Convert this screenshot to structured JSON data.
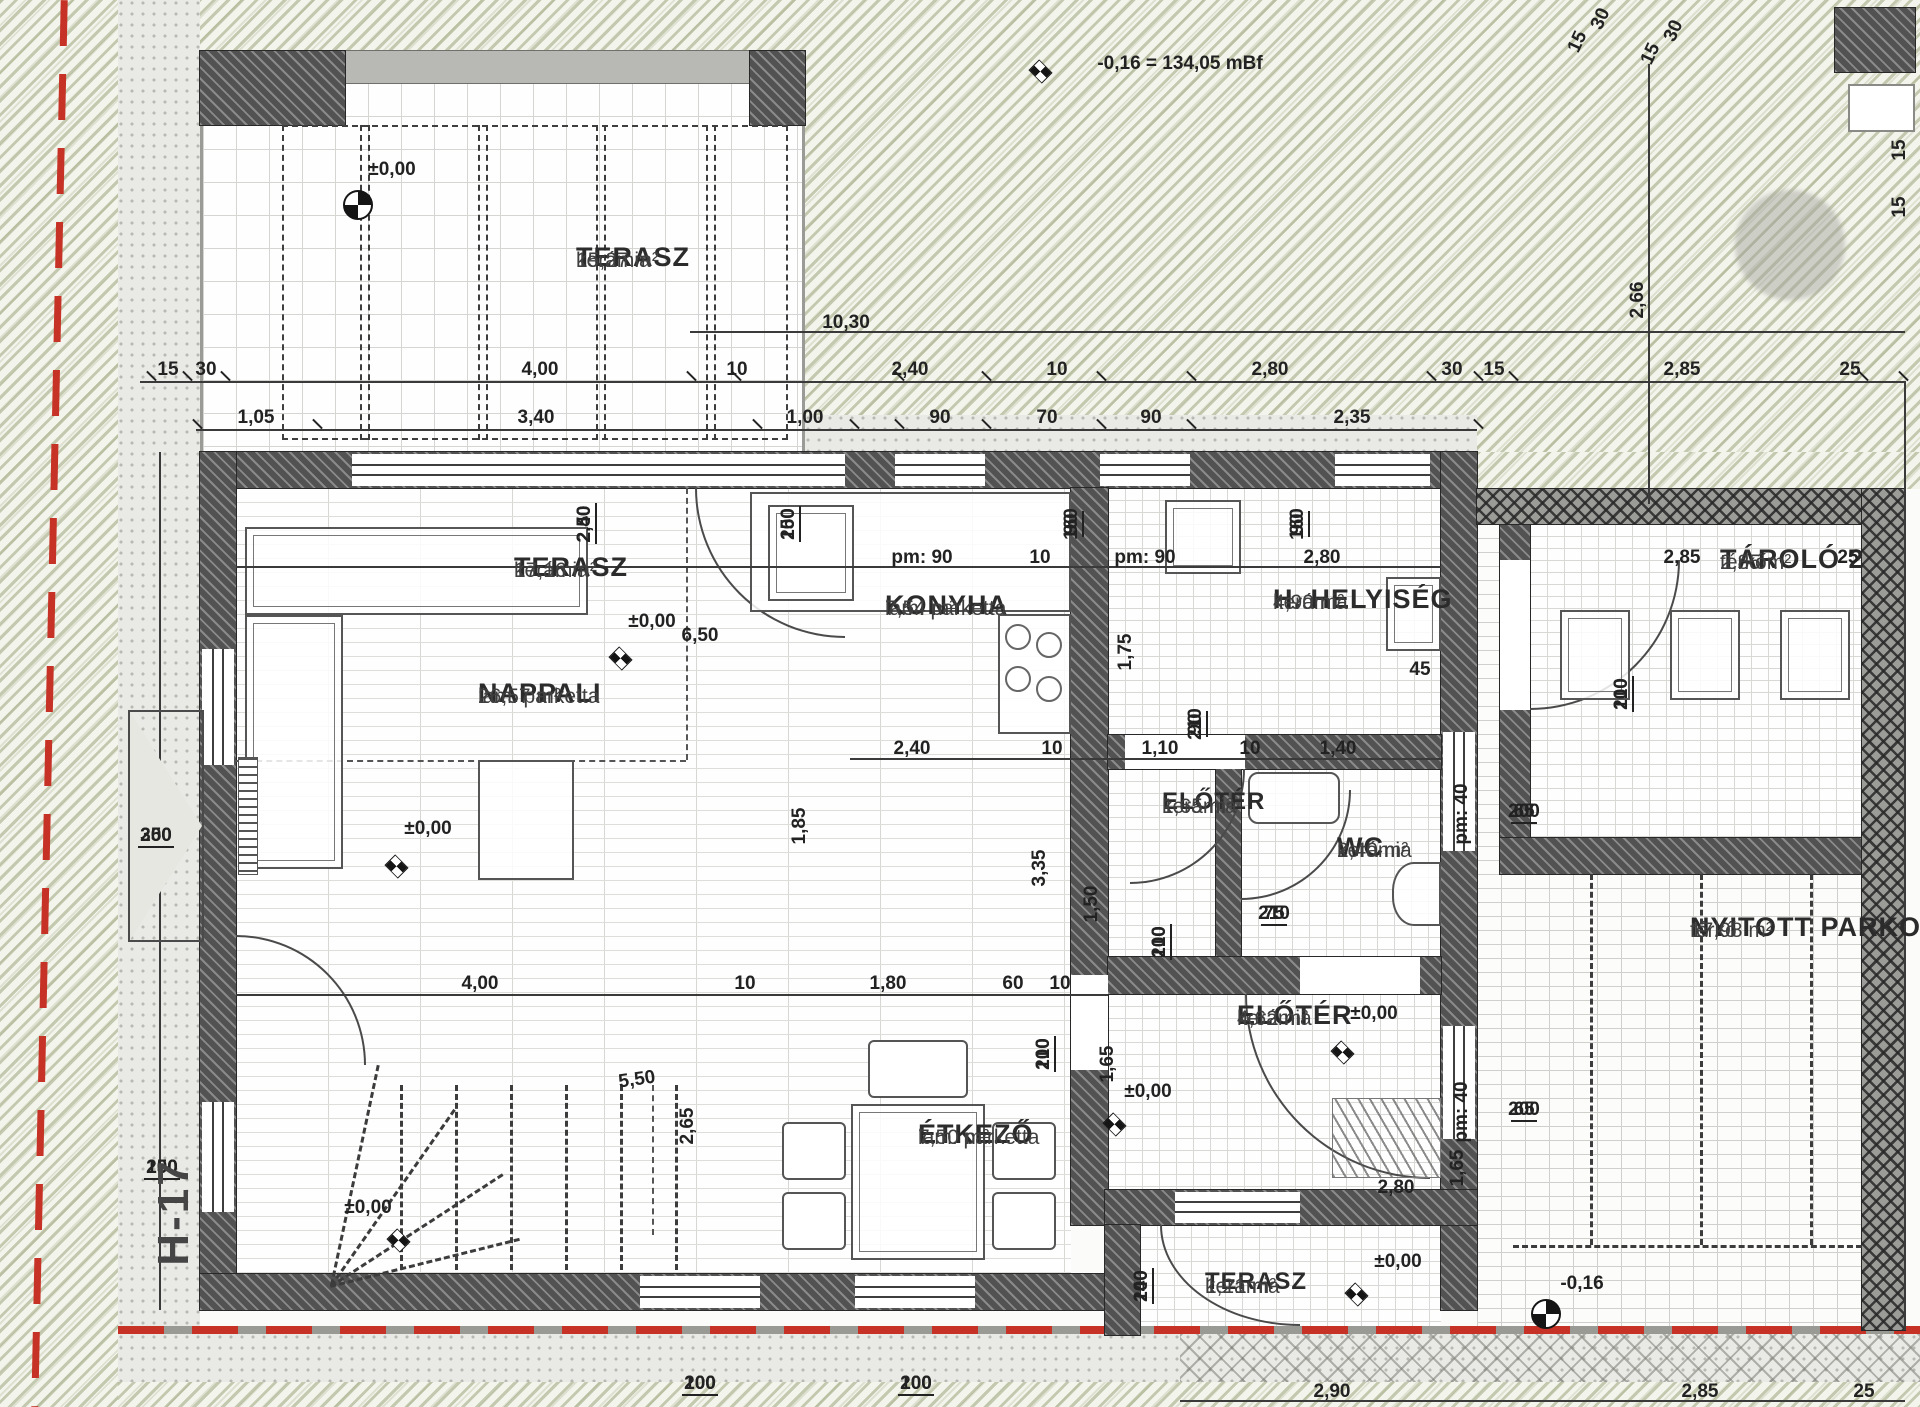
{
  "document": {
    "type": "floor-plan",
    "language": "hu",
    "drawing": "földszinti alaprajz"
  },
  "reference_levels": {
    "benchmark": "-0,16 = 134,05 mBf",
    "zero_level": "±0,00",
    "terrain_level": "-0,16"
  },
  "colors": {
    "wall": "#525252",
    "line": "#3a3a3a",
    "text": "#222222",
    "green_hatch": "#949e72",
    "property_line_red": "#c63226",
    "paper": "#fbfbf9"
  },
  "section_marker": "H-17",
  "rooms": [
    {
      "key": "terasz-felso",
      "name": "TERASZ",
      "material": "kerámia",
      "area": "15,27 m²"
    },
    {
      "key": "terasz-fedett",
      "name": "TERASZ",
      "material": "kerámia",
      "area": "17,16 m²"
    },
    {
      "key": "nappali",
      "name": "NAPPALI",
      "material": "lam. parketta",
      "area": "26,57 m²"
    },
    {
      "key": "konyha",
      "name": "KONYHA",
      "material": "lam. parketta",
      "area": "7,54 m²"
    },
    {
      "key": "h-helyiseg",
      "name": "H. HELYISÉG",
      "material": "kerámia",
      "area": "4,90 m²"
    },
    {
      "key": "eloter-felso",
      "name": "ELŐTÉR",
      "material": "kerámia",
      "area": "1,65 m²"
    },
    {
      "key": "wc",
      "name": "WC",
      "material": "kerámia",
      "area": "2,40 m²"
    },
    {
      "key": "eloter-also",
      "name": "ELŐTÉR",
      "material": "kerámia",
      "area": "4,62 m²"
    },
    {
      "key": "etkezo",
      "name": "ÉTKEZŐ",
      "material": "lam. parketta",
      "area": "7,50 m²"
    },
    {
      "key": "terasz-also",
      "name": "TERASZ",
      "material": "kerámia",
      "area": "1,21 m²"
    },
    {
      "key": "tarolo-2",
      "name": "TÁROLÓ 2",
      "material": "térkő",
      "area": "2,85 m²"
    },
    {
      "key": "nyitott-parkolo",
      "name": "NYITOTT PARKOLÓ",
      "material": "térkő",
      "area": "17,98 m²"
    }
  ],
  "annotations": [
    {
      "t": "-0,16 = 134,05 mBf",
      "x": 1180,
      "y": 64
    },
    {
      "t": "10,30",
      "x": 846,
      "y": 323
    },
    {
      "t": "15",
      "x": 168,
      "y": 370
    },
    {
      "t": "30",
      "x": 206,
      "y": 370
    },
    {
      "t": "4,00",
      "x": 540,
      "y": 370
    },
    {
      "t": "10",
      "x": 737,
      "y": 370
    },
    {
      "t": "2,40",
      "x": 910,
      "y": 370
    },
    {
      "t": "10",
      "x": 1057,
      "y": 370
    },
    {
      "t": "2,80",
      "x": 1270,
      "y": 370
    },
    {
      "t": "30",
      "x": 1452,
      "y": 370
    },
    {
      "t": "15",
      "x": 1494,
      "y": 370
    },
    {
      "t": "2,85",
      "x": 1682,
      "y": 370
    },
    {
      "t": "25",
      "x": 1850,
      "y": 370
    },
    {
      "t": "1,05",
      "x": 256,
      "y": 418
    },
    {
      "t": "3,40",
      "x": 536,
      "y": 418
    },
    {
      "t": "1,00",
      "x": 805,
      "y": 418
    },
    {
      "t": "90",
      "x": 940,
      "y": 418
    },
    {
      "t": "70",
      "x": 1047,
      "y": 418
    },
    {
      "t": "90",
      "x": 1151,
      "y": 418
    },
    {
      "t": "2,35",
      "x": 1352,
      "y": 418
    },
    {
      "t": "2,66",
      "x": 1638,
      "y": 300,
      "r": -90
    },
    {
      "t": "15",
      "x": 1578,
      "y": 42,
      "r": -65
    },
    {
      "t": "30",
      "x": 1601,
      "y": 19,
      "r": -65
    },
    {
      "t": "15",
      "x": 1651,
      "y": 54,
      "r": -65
    },
    {
      "t": "30",
      "x": 1674,
      "y": 31,
      "r": -65
    },
    {
      "t": "15",
      "x": 1900,
      "y": 150,
      "r": -90
    },
    {
      "t": "15",
      "x": 1900,
      "y": 207,
      "r": -90
    },
    {
      "t": "±0,00",
      "x": 392,
      "y": 170
    },
    {
      "t": "2,40/2,50",
      "x": 575,
      "y": 524,
      "r": -90,
      "c": "f"
    },
    {
      "t": "100/250",
      "x": 779,
      "y": 524,
      "r": -90,
      "c": "f"
    },
    {
      "t": "90/160",
      "x": 1062,
      "y": 524,
      "r": -90,
      "c": "f"
    },
    {
      "t": "90/160",
      "x": 1288,
      "y": 524,
      "r": -90,
      "c": "f"
    },
    {
      "t": "pm: 90",
      "x": 922,
      "y": 558
    },
    {
      "t": "10",
      "x": 1040,
      "y": 558
    },
    {
      "t": "pm: 90",
      "x": 1145,
      "y": 558
    },
    {
      "t": "2,80",
      "x": 1322,
      "y": 558
    },
    {
      "t": "6,50",
      "x": 700,
      "y": 636
    },
    {
      "t": "±0,00",
      "x": 652,
      "y": 622
    },
    {
      "t": "±0,00",
      "x": 428,
      "y": 829
    },
    {
      "t": "2,40",
      "x": 912,
      "y": 749
    },
    {
      "t": "10",
      "x": 1052,
      "y": 749
    },
    {
      "t": "1,10",
      "x": 1160,
      "y": 749
    },
    {
      "t": "10",
      "x": 1250,
      "y": 749
    },
    {
      "t": "1,40",
      "x": 1338,
      "y": 749
    },
    {
      "t": "1,75",
      "x": 1126,
      "y": 652,
      "r": -90
    },
    {
      "t": "45",
      "x": 1420,
      "y": 670
    },
    {
      "t": "90/210",
      "x": 1186,
      "y": 724,
      "r": -90,
      "c": "f"
    },
    {
      "t": "1,85",
      "x": 800,
      "y": 826,
      "r": -90
    },
    {
      "t": "3,35",
      "x": 1040,
      "y": 868,
      "r": -90
    },
    {
      "t": "1,50",
      "x": 1092,
      "y": 904,
      "r": -90
    },
    {
      "t": "75/210",
      "x": 1274,
      "y": 904,
      "c": "f"
    },
    {
      "t": "100/210",
      "x": 1150,
      "y": 942,
      "r": -90,
      "c": "f"
    },
    {
      "t": "pm: 40",
      "x": 1462,
      "y": 814,
      "r": -90
    },
    {
      "t": "65/200",
      "x": 1524,
      "y": 802,
      "c": "f"
    },
    {
      "t": "pm: 40",
      "x": 1462,
      "y": 1112,
      "r": -90
    },
    {
      "t": "65/200",
      "x": 1524,
      "y": 1100,
      "c": "f"
    },
    {
      "t": "4,00",
      "x": 480,
      "y": 984
    },
    {
      "t": "10",
      "x": 745,
      "y": 984
    },
    {
      "t": "1,80",
      "x": 888,
      "y": 984
    },
    {
      "t": "60",
      "x": 1013,
      "y": 984
    },
    {
      "t": "10",
      "x": 1060,
      "y": 984
    },
    {
      "t": "100/210",
      "x": 1034,
      "y": 1054,
      "r": -90,
      "c": "f"
    },
    {
      "t": "5,50",
      "x": 637,
      "y": 1080,
      "r": -8
    },
    {
      "t": "2,65",
      "x": 688,
      "y": 1126,
      "r": -90
    },
    {
      "t": "1,65",
      "x": 1108,
      "y": 1064,
      "r": -90
    },
    {
      "t": "±0,00",
      "x": 1374,
      "y": 1014
    },
    {
      "t": "±0,00",
      "x": 1148,
      "y": 1092
    },
    {
      "t": "2,80",
      "x": 1396,
      "y": 1188
    },
    {
      "t": "1,65",
      "x": 1458,
      "y": 1168,
      "r": -90
    },
    {
      "t": "±0,00",
      "x": 368,
      "y": 1208
    },
    {
      "t": "±0,00",
      "x": 1398,
      "y": 1262
    },
    {
      "t": "100/240",
      "x": 1132,
      "y": 1286,
      "r": -90,
      "c": "f"
    },
    {
      "t": "100/200",
      "x": 700,
      "y": 1374,
      "c": "f"
    },
    {
      "t": "100/200",
      "x": 916,
      "y": 1374,
      "c": "f"
    },
    {
      "t": "300/250",
      "x": 156,
      "y": 826,
      "c": "f"
    },
    {
      "t": "100/250",
      "x": 162,
      "y": 1158,
      "c": "f"
    },
    {
      "t": "H-17",
      "x": 174,
      "y": 1212,
      "r": -90,
      "c": "big"
    },
    {
      "t": "100/210",
      "x": 1612,
      "y": 694,
      "r": -90,
      "c": "f"
    },
    {
      "t": "2,85",
      "x": 1682,
      "y": 558
    },
    {
      "t": "25",
      "x": 1848,
      "y": 558
    },
    {
      "t": "2,90",
      "x": 1332,
      "y": 1392
    },
    {
      "t": "2,85",
      "x": 1700,
      "y": 1392
    },
    {
      "t": "25",
      "x": 1864,
      "y": 1392
    },
    {
      "t": "-0,16",
      "x": 1582,
      "y": 1284
    }
  ]
}
